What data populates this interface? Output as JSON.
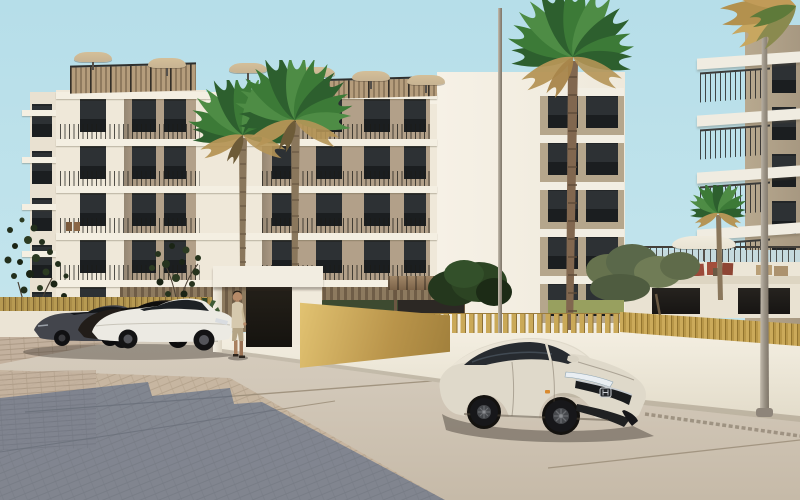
{
  "meta": {
    "scene_type": "architectural-3d-render",
    "description": "Sunny exterior render of a modern cream apartment complex with palm trees, gold slatted fence, parked cars and a white sedan in the foreground",
    "visible_text": ""
  },
  "palette": {
    "sky_top": "#b6dee9",
    "sky_mid": "#c2e4ec",
    "sky_bottom": "#cfeaf0",
    "cream": "#efe8d9",
    "cream_light": "#f5f0e4",
    "slab_white": "#f4efe2",
    "bay_tan": "#b2a089",
    "window_dark": "#24262a",
    "wood_slat": "#a98f6d",
    "gold": "#caa958",
    "gold_dark": "#8a6f35",
    "brass_light": "#e2c372",
    "wall_white": "#f0ebdd",
    "pavement": "#d3c9ba",
    "pavement_deep": "#c6baa8",
    "brick": "#c3b19e",
    "shadow_blue": "#3c567f",
    "palm_green": "#3c7a37",
    "palm_green_dark": "#2d5f2e",
    "palm_dry": "#b59556",
    "trunk_brown": "#8a775c",
    "pole_gray": "#978f82",
    "honda_cream": "#dfd9ca",
    "glass_dark": "#272b30",
    "car_white": "#eceae3",
    "car_dark": "#221d19",
    "car_gray": "#43454c",
    "grass": "#98a05f",
    "umbrella_tan": "#c7b392",
    "umbrella_white": "#e9e3d3",
    "annex_white": "#ece6d7",
    "chair_red": "#9c4a3a",
    "skin": "#b78a68",
    "shirt_beige": "#d6c9ae",
    "shorts_tan": "#b5a586",
    "olive_green": "#5f6b4a"
  },
  "scene": {
    "objects": [
      "main-apartment-building",
      "right-apartment-building",
      "annex-terrace",
      "rooftop-umbrellas",
      "palm-trees",
      "olive-trees",
      "gold-slat-fence",
      "entrance-portal",
      "brass-wall-panel",
      "pedestrian-man",
      "parked-dark-sedan",
      "parked-dark-coupe",
      "parked-white-coupe",
      "white-honda-sedan",
      "street-light-poles",
      "paved-plaza",
      "building-shadow"
    ]
  }
}
